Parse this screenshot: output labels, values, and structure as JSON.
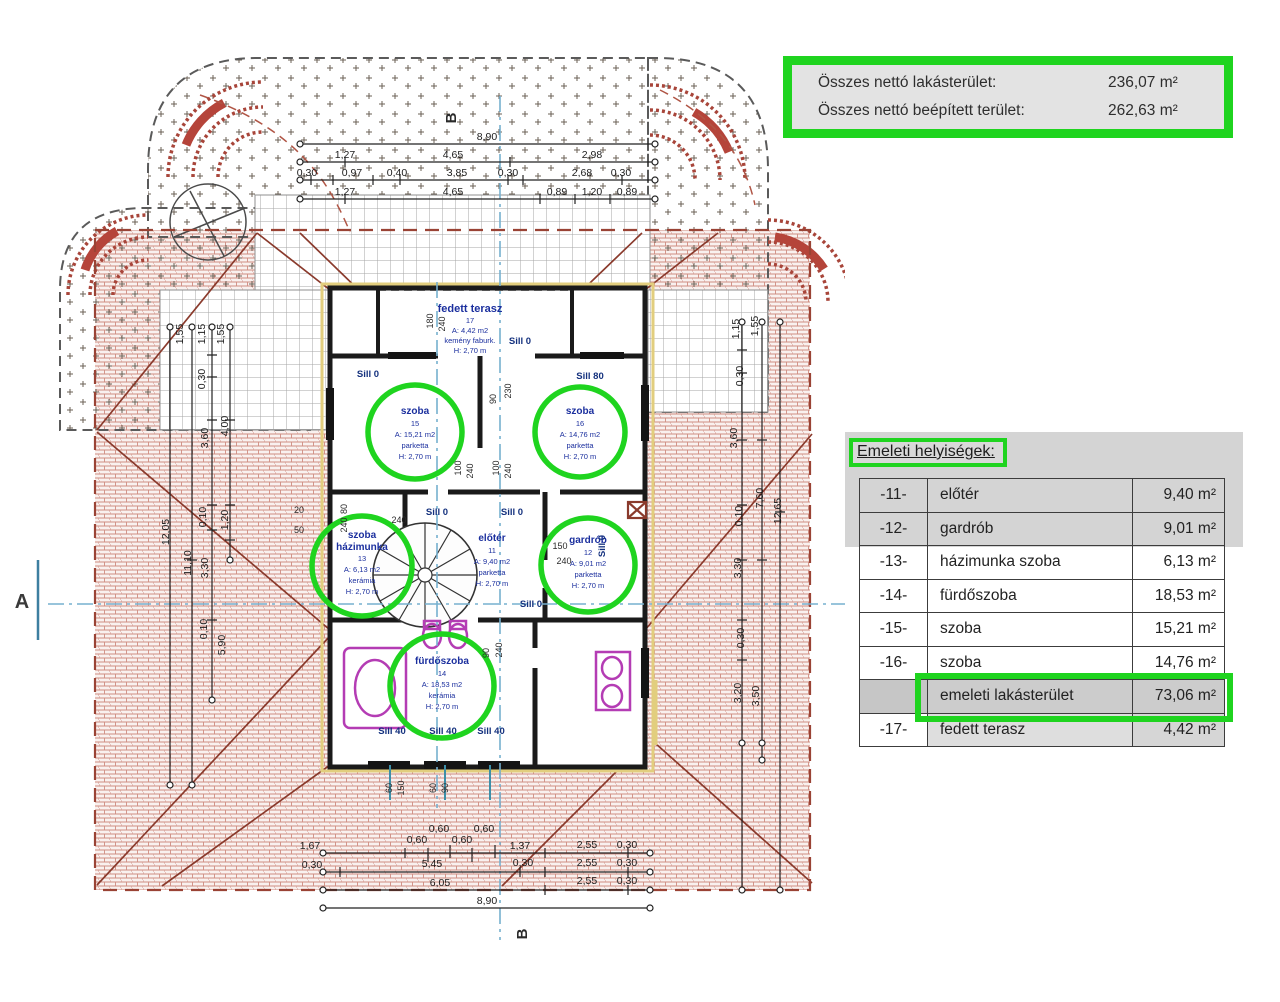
{
  "summary": {
    "rows": [
      {
        "label": "Összes nettó lakásterület:",
        "value": "236,07 m²"
      },
      {
        "label": "Összes nettó beépített terület:",
        "value": "262,63 m²"
      }
    ]
  },
  "rooms_table": {
    "title": "Emeleti helyiségek:",
    "rows": [
      {
        "code": "-11-",
        "name": "előtér",
        "value": "9,40 m²"
      },
      {
        "code": "-12-",
        "name": "gardrób",
        "value": "9,01 m²"
      },
      {
        "code": "-13-",
        "name": "házimunka  szoba",
        "value": "6,13 m²"
      },
      {
        "code": "-14-",
        "name": "fürdőszoba",
        "value": "18,53 m²"
      },
      {
        "code": "-15-",
        "name": "szoba",
        "value": "15,21 m²"
      },
      {
        "code": "-16-",
        "name": "szoba",
        "value": "14,76 m²"
      },
      {
        "code": "",
        "name": "emeleti lakásterület",
        "value": "73,06 m²"
      },
      {
        "code": "-17-",
        "name": "fedett terasz",
        "value": "4,42 m²"
      }
    ]
  },
  "plan": {
    "markers": {
      "a": "A",
      "b": "B"
    },
    "rooms": {
      "terasz": {
        "l1": "fedett terasz",
        "l2": "17",
        "l3": "A: 4,42 m2",
        "l4": "kemény faburk.",
        "l5": "H: 2,70 m"
      },
      "szoba15": {
        "l1": "szoba",
        "l2": "15",
        "l3": "A: 15,21 m2",
        "l4": "parketta",
        "l5": "H: 2,70 m"
      },
      "szoba16": {
        "l1": "szoba",
        "l2": "16",
        "l3": "A: 14,76 m2",
        "l4": "parketta",
        "l5": "H: 2,70 m"
      },
      "hazimunka": {
        "l1": "szoba",
        "l2": "házimunka",
        "l3": "13",
        "l4": "A: 6,13 m2",
        "l5": "kerámia",
        "l6": "H: 2,70 m"
      },
      "eloter": {
        "l1": "előtér",
        "l2": "11",
        "l3": "A: 9,40 m2",
        "l4": "parketta",
        "l5": "H: 2,70 m"
      },
      "gardrob": {
        "l1": "gardrób",
        "l2": "12",
        "l3": "A: 9,01 m2",
        "l4": "parketta",
        "l5": "H: 2,70 m"
      },
      "furdo": {
        "l1": "fürdőszoba",
        "l2": "14",
        "l3": "A: 18,53 m2",
        "l4": "kerámia",
        "l5": "H: 2,70 m"
      }
    },
    "sills": {
      "s0": "Sill 0",
      "s80": "Sill 80",
      "s40": "Sill 40"
    },
    "dims": {
      "top1": [
        "8,90"
      ],
      "top2": [
        "1,27",
        "4,65",
        "2,98"
      ],
      "top3": [
        "0,30",
        "0,97",
        "0,40",
        "3,85",
        "0,30",
        "2,68",
        "0,30"
      ],
      "top4": [
        "1,27",
        "4,65",
        "0,89",
        "1,20",
        "0,89"
      ],
      "bot1": [
        "1,67",
        "0,60",
        "0,60",
        "0,60",
        "0,60",
        "1,37",
        "2,55",
        "0,30"
      ],
      "bot2": [
        "0,30",
        "5,45",
        "0,30",
        "2,55",
        "0,30"
      ],
      "bot3": [
        "6,05",
        "2,55",
        "0,30"
      ],
      "bot4": [
        "8,90"
      ],
      "left": [
        "1,55",
        "1,15",
        "1,55",
        "0,30",
        "3,60",
        "4,00",
        "0,10",
        "1,20",
        "12,05",
        "11,10",
        "3,30",
        "0,10",
        "5,90"
      ],
      "right": [
        "1,15",
        "1,55",
        "0,30",
        "3,60",
        "7,60",
        "0,10",
        "12,65",
        "3,30",
        "0,30",
        "3,20",
        "3,50"
      ],
      "win": [
        "90",
        "230",
        "180",
        "240",
        "100",
        "240",
        "100",
        "240",
        "80",
        "240",
        "20",
        "50",
        "240",
        "150",
        "240",
        "90",
        "240",
        "60",
        "150",
        "60",
        "90"
      ]
    }
  }
}
